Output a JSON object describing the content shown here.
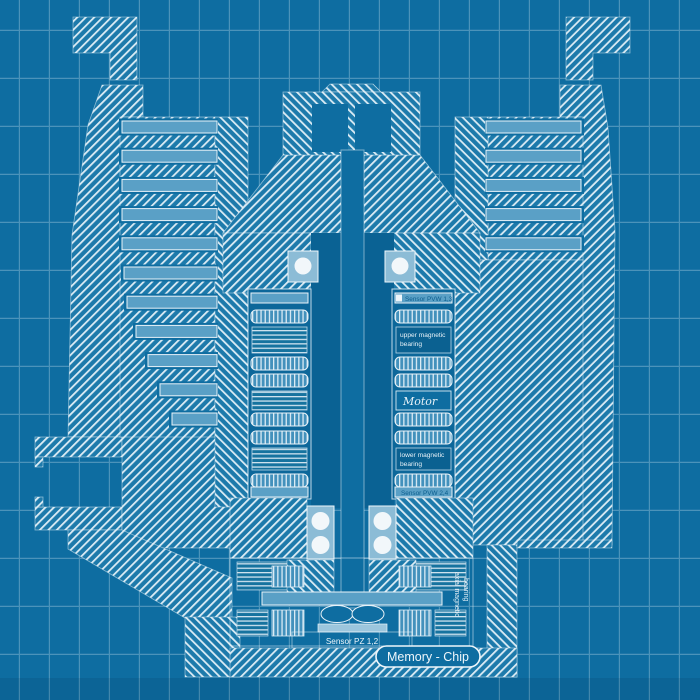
{
  "title": "turbomolecular pump cross-section blueprint",
  "labels": {
    "sensor_top": "Sensor PVW 1,3",
    "upper_bearing_l1": "upper magnetic",
    "upper_bearing_l2": "bearing",
    "motor": "Motor",
    "lower_bearing_l1": "lower magnetic",
    "lower_bearing_l2": "bearing",
    "sensor_bottom": "Sensor PVW 2,4",
    "sensor_pz": "Sensor PZ 1,2",
    "axial_l1": "axial magnetic",
    "axial_l2": "bearing",
    "memory_chip": "Memory - Chip"
  },
  "palette": {
    "background": "#0e6da1",
    "bore_dark": "#0a6294",
    "hatch_fill": "#1d7aab",
    "hatch_line": "#dcecf5",
    "rotor_blade": "#5aa0c6",
    "bearing_housing": "#8cbcd6",
    "ball_white": "#f2f7fa",
    "label_text": "#eef6fb",
    "sensor_bar": "#5ea6cb",
    "sensor_text_dark": "#0b5d8d",
    "grid_line": "#cde4f0"
  }
}
